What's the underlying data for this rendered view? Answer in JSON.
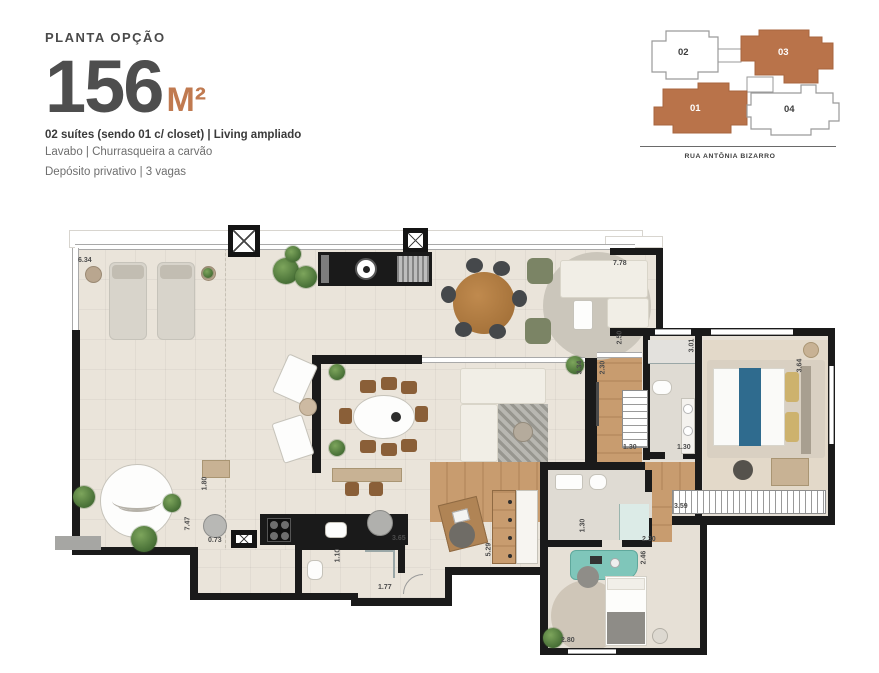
{
  "header": {
    "kicker": "PLANTA OPÇÃO",
    "area_value": "156",
    "area_unit": "M²",
    "features": {
      "line1": "02 suítes (sendo 01 c/ closet)  | Living ampliado",
      "line2": "Lavabo | Churrasqueira a carvão",
      "line3": "Depósito privativo | 3 vagas"
    }
  },
  "keyplan": {
    "street": "RUA ANTÔNIA BIZARRO",
    "highlight_color": "#b9734a",
    "units": [
      {
        "label": "02",
        "highlighted": false
      },
      {
        "label": "03",
        "highlighted": true
      },
      {
        "label": "01",
        "highlighted": true
      },
      {
        "label": "04",
        "highlighted": false
      }
    ]
  },
  "plan": {
    "dimensions": [
      {
        "id": "terrace-top-width",
        "value": "6.34"
      },
      {
        "id": "living-top-width",
        "value": "7.78"
      },
      {
        "id": "living-right-depth",
        "value": "2.50"
      },
      {
        "id": "master-bath-depth",
        "value": "3.01"
      },
      {
        "id": "hall-depth",
        "value": "2.30"
      },
      {
        "id": "living-side-depth",
        "value": "3.34"
      },
      {
        "id": "master-suite-depth",
        "value": "3.64"
      },
      {
        "id": "hall-closet-width",
        "value": "1.30"
      },
      {
        "id": "master-bath-width",
        "value": "1.30"
      },
      {
        "id": "master-closet-width",
        "value": "3.59"
      },
      {
        "id": "pantry-depth",
        "value": "1.80"
      },
      {
        "id": "terrace-left-depth",
        "value": "7.47"
      },
      {
        "id": "column-width",
        "value": "0.73"
      },
      {
        "id": "kitchen-width",
        "value": "3.65"
      },
      {
        "id": "lavabo-depth",
        "value": "1.10"
      },
      {
        "id": "lavabo-width",
        "value": "1.77"
      },
      {
        "id": "hall2-depth",
        "value": "5.29"
      },
      {
        "id": "suite2-bath-width",
        "value": "2.30"
      },
      {
        "id": "suite2-bath-depth",
        "value": "1.30"
      },
      {
        "id": "suite2-depth",
        "value": "2.46"
      },
      {
        "id": "suite2-width",
        "value": "2.80"
      }
    ]
  },
  "colors": {
    "accent_orange": "#b9734a",
    "unit_label_dark": "#3d3d3d",
    "title_gray": "#4e4e4e",
    "wall_black": "#1a1a1a",
    "floor_beige": "#eae4da",
    "wood": "#c89c6f"
  }
}
